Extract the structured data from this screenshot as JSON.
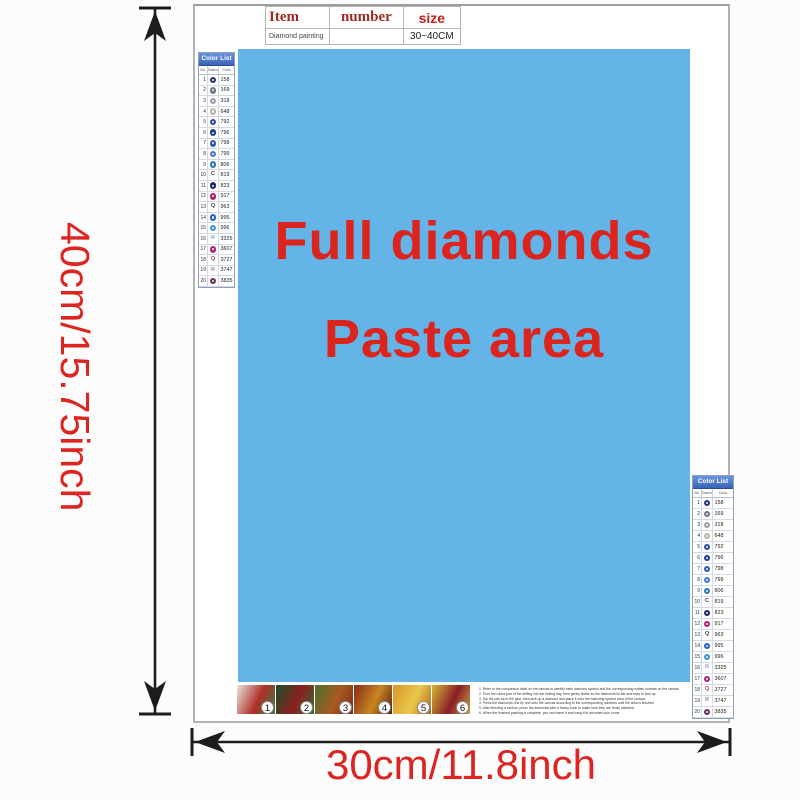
{
  "dimensions": {
    "height_label": "40cm/15.75inch",
    "width_label": "30cm/11.8inch",
    "arrow_color": "#1c1c1c",
    "label_color": "#dd2420"
  },
  "item_table": {
    "col_item": "Item",
    "col_number": "number",
    "col_size": "size",
    "item_value": "Diamond painting",
    "number_value": "",
    "size_value": "30~40CM"
  },
  "paste_area": {
    "line1": "Full diamonds",
    "line2": "Paste area",
    "bg_color": "#64b4e8",
    "text_color": "#dc241f"
  },
  "color_list": {
    "title": "Color List",
    "columns": [
      "No.",
      "Diamond",
      "Color"
    ],
    "rows": [
      {
        "no": "1",
        "type": "circle",
        "sym": "",
        "color": "#26337e",
        "code": "158"
      },
      {
        "no": "2",
        "type": "circle",
        "sym": "",
        "color": "#6f7685",
        "code": "169"
      },
      {
        "no": "3",
        "type": "circle",
        "sym": "",
        "color": "#9aa0a8",
        "code": "318"
      },
      {
        "no": "4",
        "type": "circle",
        "sym": "",
        "color": "#b4b8ab",
        "code": "648"
      },
      {
        "no": "5",
        "type": "circle",
        "sym": "",
        "color": "#2f4c9e",
        "code": "792"
      },
      {
        "no": "6",
        "type": "circle",
        "sym": "",
        "color": "#1f3d94",
        "code": "796"
      },
      {
        "no": "7",
        "type": "circle",
        "sym": "",
        "color": "#2d5bb4",
        "code": "798"
      },
      {
        "no": "8",
        "type": "circle",
        "sym": "",
        "color": "#4a77c9",
        "code": "799"
      },
      {
        "no": "9",
        "type": "circle",
        "sym": "",
        "color": "#2d7ab8",
        "code": "806"
      },
      {
        "no": "10",
        "type": "letter",
        "sym": "C",
        "color": "#444444",
        "code": "819"
      },
      {
        "no": "11",
        "type": "circle",
        "sym": "",
        "color": "#1a2a66",
        "code": "823"
      },
      {
        "no": "12",
        "type": "circle",
        "sym": "",
        "color": "#b02470",
        "code": "917"
      },
      {
        "no": "13",
        "type": "letter",
        "sym": "Q",
        "color": "#444444",
        "code": "963"
      },
      {
        "no": "14",
        "type": "circle",
        "sym": "",
        "color": "#1f64c8",
        "code": "995"
      },
      {
        "no": "15",
        "type": "circle",
        "sym": "",
        "color": "#3f90dd",
        "code": "996"
      },
      {
        "no": "16",
        "type": "letter",
        "sym": "R",
        "color": "#8fa8c8",
        "code": "3325"
      },
      {
        "no": "17",
        "type": "circle",
        "sym": "",
        "color": "#a62784",
        "code": "3607"
      },
      {
        "no": "18",
        "type": "letter",
        "sym": "Q",
        "color": "#a14a62",
        "code": "3727"
      },
      {
        "no": "19",
        "type": "letter",
        "sym": "R",
        "color": "#8a8aa8",
        "code": "3747"
      },
      {
        "no": "20",
        "type": "circle",
        "sym": "",
        "color": "#6d2f5e",
        "code": "3835"
      }
    ]
  },
  "steps": [
    {
      "no": "1",
      "colors": [
        "#e8e6e0",
        "#b03028",
        "#3d7a40"
      ]
    },
    {
      "no": "2",
      "colors": [
        "#1c4d26",
        "#8a2020",
        "#3a6b2e"
      ]
    },
    {
      "no": "3",
      "colors": [
        "#4a7030",
        "#a85a20",
        "#7a2818"
      ]
    },
    {
      "no": "4",
      "colors": [
        "#8a2a1a",
        "#c8861f",
        "#5a1c14"
      ]
    },
    {
      "no": "5",
      "colors": [
        "#d99427",
        "#e8c84a",
        "#b4651e"
      ]
    },
    {
      "no": "6",
      "colors": [
        "#d4b832",
        "#8a1e28",
        "#caa23c"
      ]
    }
  ],
  "instructions": [
    "1. Refer to the comparison table on the canvas to identify each diamond symbol and the corresponding written number on the canvas.",
    "2. Pour the round part of the drilling into the drilling tray, then gently shake so the diamonds lie flat and easy to pick up.",
    "3. Dip the pen tip in the glue, then pick up a diamond and place it onto the matching symbol area of the canvas.",
    "4. Press the diamonds one by one onto the canvas according to the corresponding numbers until the area is finished.",
    "5. After finishing a section, press the diamonds with a heavy book to make sure they are firmly attached.",
    "6. When the finished painting is complete, you can frame it and hang it to decorate your home."
  ]
}
